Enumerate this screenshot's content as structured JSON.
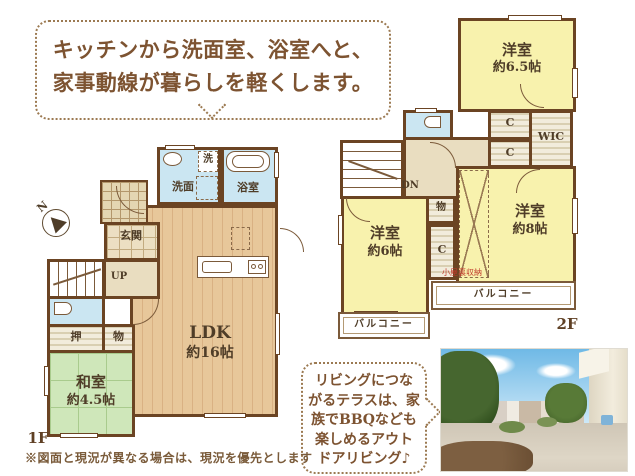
{
  "bubble_top": {
    "line1": "キッチンから洗面室、浴室へと、",
    "line2": "家事動線が暮らしを軽くします。"
  },
  "bubble_bottom": {
    "lines": [
      "リビングにつな",
      "がるテラスは、家",
      "族でBBQなども",
      "楽しめるアウト",
      "ドアリビング♪"
    ]
  },
  "compass": {
    "north": "N"
  },
  "floor1": {
    "label": "1F",
    "ldk_name": "LDK",
    "ldk_size": "約16帖",
    "washitsu_name": "和室",
    "washitsu_size": "約4.5帖",
    "senmen": "洗面",
    "bath": "浴室",
    "washer": "洗",
    "genkan": "玄関",
    "oshiire": "押",
    "mono": "物",
    "up": "UP"
  },
  "floor2": {
    "label": "2F",
    "bed65_name": "洋室",
    "bed65_size": "約6.5帖",
    "bed8_name": "洋室",
    "bed8_size": "約8帖",
    "bed6_name": "洋室",
    "bed6_size": "約6帖",
    "wic": "WIC",
    "closets": [
      "C",
      "C",
      "C"
    ],
    "mono": "物",
    "dn": "DN",
    "attic_note": "小屋裏収納",
    "balconies": [
      "バルコニー",
      "バルコニー"
    ]
  },
  "disclaimer": "※図面と現況が異なる場合は、現況を優先とします",
  "colors": {
    "wall": "#6b4423",
    "text_brown": "#7d5331",
    "water_blue": "#cbe6f2",
    "room_yellow": "#f8f2ad",
    "tatami_green": "#cfe7ba",
    "wood_floor": "#e7c79a",
    "note_red": "#c03a2b"
  }
}
